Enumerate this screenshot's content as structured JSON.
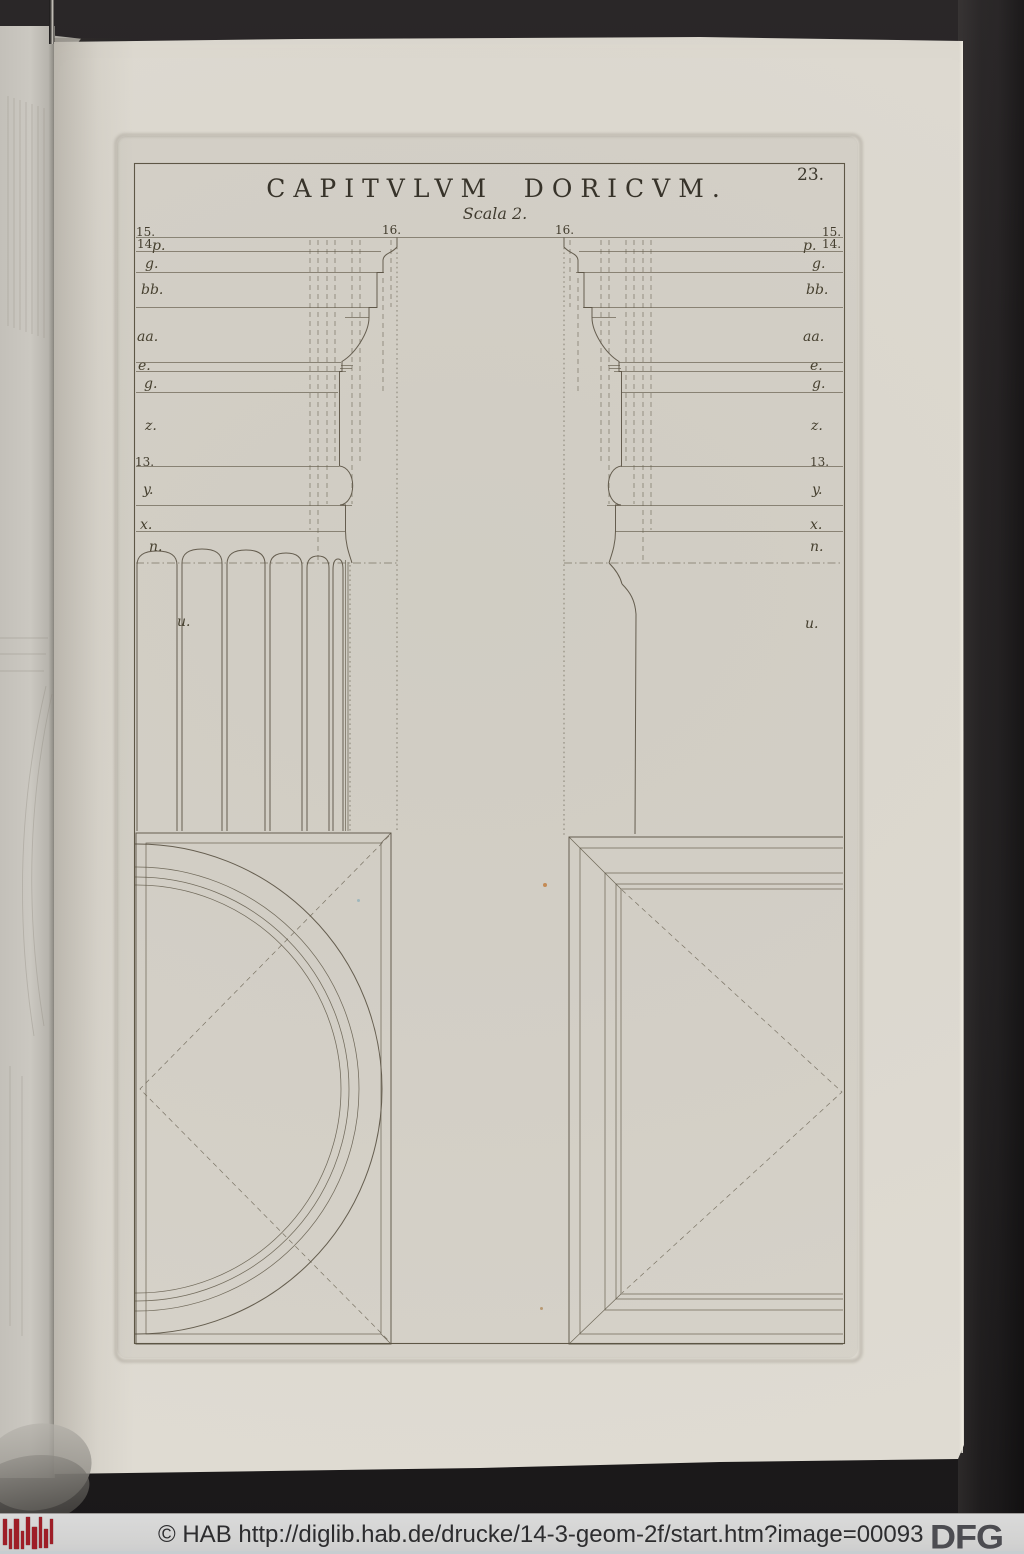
{
  "document": {
    "page_number": "23.",
    "title": "CAPITVLVM DORICVM.",
    "scale_note": "Scala 2.",
    "module_tick_left": "16.",
    "module_tick_right": "16.",
    "labels_left": [
      "15.",
      "14.",
      "p.",
      "g.",
      "bb.",
      "aa.",
      "e.",
      "g.",
      "z.",
      "13.",
      "y.",
      "x.",
      "n.",
      "u."
    ],
    "labels_right": [
      "p.",
      "15.",
      "14.",
      "g.",
      "bb.",
      "aa.",
      "e.",
      "g.",
      "z.",
      "13.",
      "y.",
      "x.",
      "n.",
      "u."
    ]
  },
  "footer": {
    "caption": "© HAB http://diglib.hab.de/drucke/14-3-geom-2f/start.htm?image=00093",
    "logo_text": "DFG",
    "bar_color": "#d6d5d3",
    "text_color": "#2d2d2f",
    "logo_color": "#4c4c51",
    "calibration_red": "#9e1e27"
  },
  "palette": {
    "background": "#242122",
    "paper": "#dcd8cf",
    "plate_tone": "#d5d1c8",
    "ink": "#5b5444"
  }
}
